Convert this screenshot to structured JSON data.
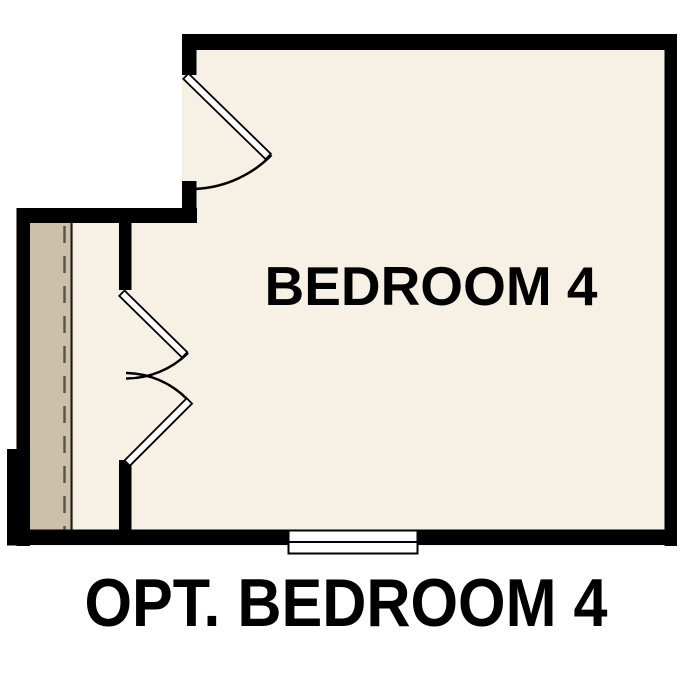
{
  "floorplan": {
    "room_label": "BEDROOM 4",
    "caption": "OPT. BEDROOM 4"
  },
  "colors": {
    "background": "#ffffff",
    "floor": "#f7f0e4",
    "strip": "#ccc0a8",
    "wall": "#000000",
    "window": "#ffffff",
    "text": "#000000"
  }
}
